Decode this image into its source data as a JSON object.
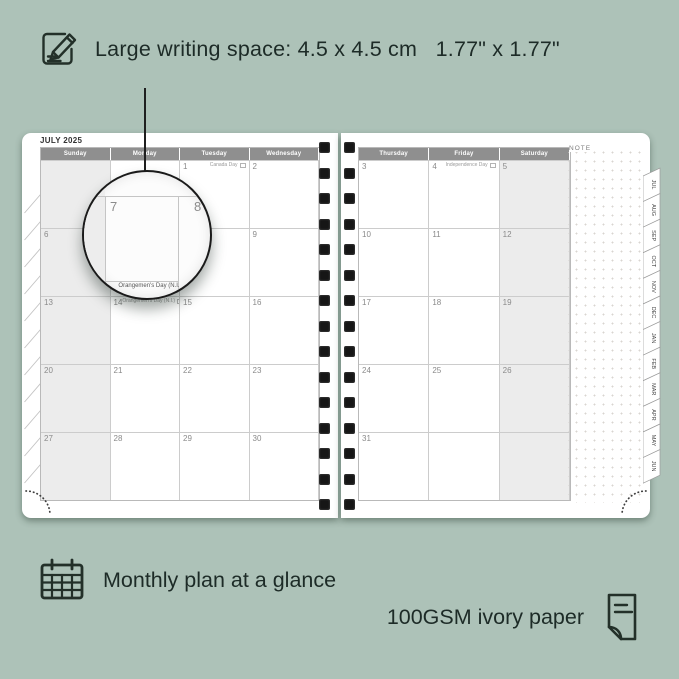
{
  "colors": {
    "background": "#adc2b8",
    "ink": "#1d2b27",
    "page": "#ffffff",
    "header_bar": "#8f8f8f",
    "weekend_fill": "#ececec",
    "grid_line": "#cccccc",
    "binding_hole": "#161616"
  },
  "annotations": {
    "top": {
      "icon": "pencil-note-icon",
      "text": "Large writing space: 4.5 x 4.5 cm   1.77\" x 1.77\""
    },
    "bottom_left": {
      "icon": "calendar-grid-icon",
      "text": "Monthly plan at a glance"
    },
    "bottom_right": {
      "icon": "paper-sheet-icon",
      "text": "100GSM ivory paper"
    }
  },
  "planner": {
    "month_title": "JULY 2025",
    "note_label": "NOTE",
    "left_days": [
      "Sunday",
      "Monday",
      "Tuesday",
      "Wednesday"
    ],
    "right_days": [
      "Thursday",
      "Friday",
      "Saturday"
    ],
    "left_cells": [
      {
        "d": "",
        "h": ""
      },
      {
        "d": "",
        "h": ""
      },
      {
        "d": "1",
        "h": "Canada Day"
      },
      {
        "d": "2",
        "h": ""
      },
      {
        "d": "6",
        "h": ""
      },
      {
        "d": "7",
        "h": ""
      },
      {
        "d": "8",
        "h": ""
      },
      {
        "d": "9",
        "h": ""
      },
      {
        "d": "13",
        "h": ""
      },
      {
        "d": "14",
        "h": "Orangemen's Day (N.I.)"
      },
      {
        "d": "15",
        "h": ""
      },
      {
        "d": "16",
        "h": ""
      },
      {
        "d": "20",
        "h": ""
      },
      {
        "d": "21",
        "h": ""
      },
      {
        "d": "22",
        "h": ""
      },
      {
        "d": "23",
        "h": ""
      },
      {
        "d": "27",
        "h": ""
      },
      {
        "d": "28",
        "h": ""
      },
      {
        "d": "29",
        "h": ""
      },
      {
        "d": "30",
        "h": ""
      }
    ],
    "right_cells": [
      {
        "d": "3",
        "h": ""
      },
      {
        "d": "4",
        "h": "Independence Day"
      },
      {
        "d": "5",
        "h": ""
      },
      {
        "d": "10",
        "h": ""
      },
      {
        "d": "11",
        "h": ""
      },
      {
        "d": "12",
        "h": ""
      },
      {
        "d": "17",
        "h": ""
      },
      {
        "d": "18",
        "h": ""
      },
      {
        "d": "19",
        "h": ""
      },
      {
        "d": "24",
        "h": ""
      },
      {
        "d": "25",
        "h": ""
      },
      {
        "d": "26",
        "h": ""
      },
      {
        "d": "31",
        "h": ""
      },
      {
        "d": "",
        "h": ""
      },
      {
        "d": "",
        "h": ""
      }
    ],
    "tabs": [
      "JUL",
      "AUG",
      "SEP",
      "OCT",
      "NOV",
      "DEC",
      "JAN",
      "FEB",
      "MAR",
      "APR",
      "MAY",
      "JUN"
    ],
    "magnifier": {
      "date_left": "7",
      "date_right": "8",
      "holiday_text": "Orangemen's Day (N.I."
    }
  }
}
